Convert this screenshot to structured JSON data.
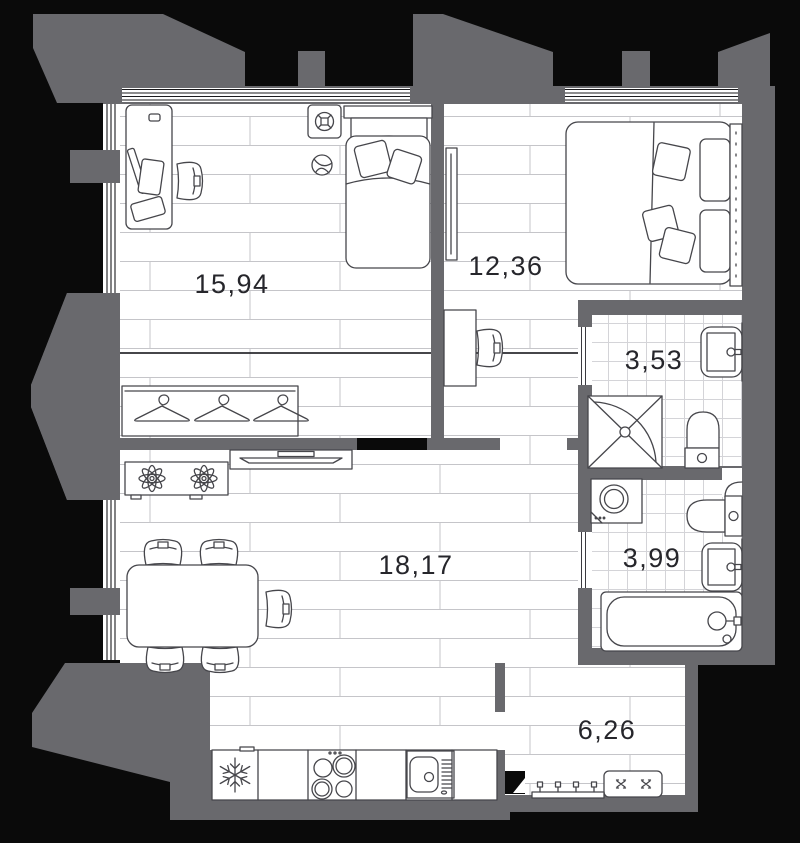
{
  "theme": {
    "background_color": "#000000",
    "wall_color": "#69696d",
    "floor_color": "#ffffff",
    "plank_line_color": "#c5c5c9",
    "tile_line_color": "#d4d4d8",
    "outline_color": "#46464b",
    "window_line_color": "#1b1b1e",
    "label_color": "#26262b"
  },
  "rooms": [
    {
      "name": "room",
      "area": "15,94"
    },
    {
      "name": "bedroom",
      "area": "12,36"
    },
    {
      "name": "bathroom",
      "area": "3,53"
    },
    {
      "name": "bathroom_2",
      "area": "3,99"
    },
    {
      "name": "living_kitchen",
      "area": "18,17"
    },
    {
      "name": "hallway",
      "area": "6,26"
    }
  ]
}
